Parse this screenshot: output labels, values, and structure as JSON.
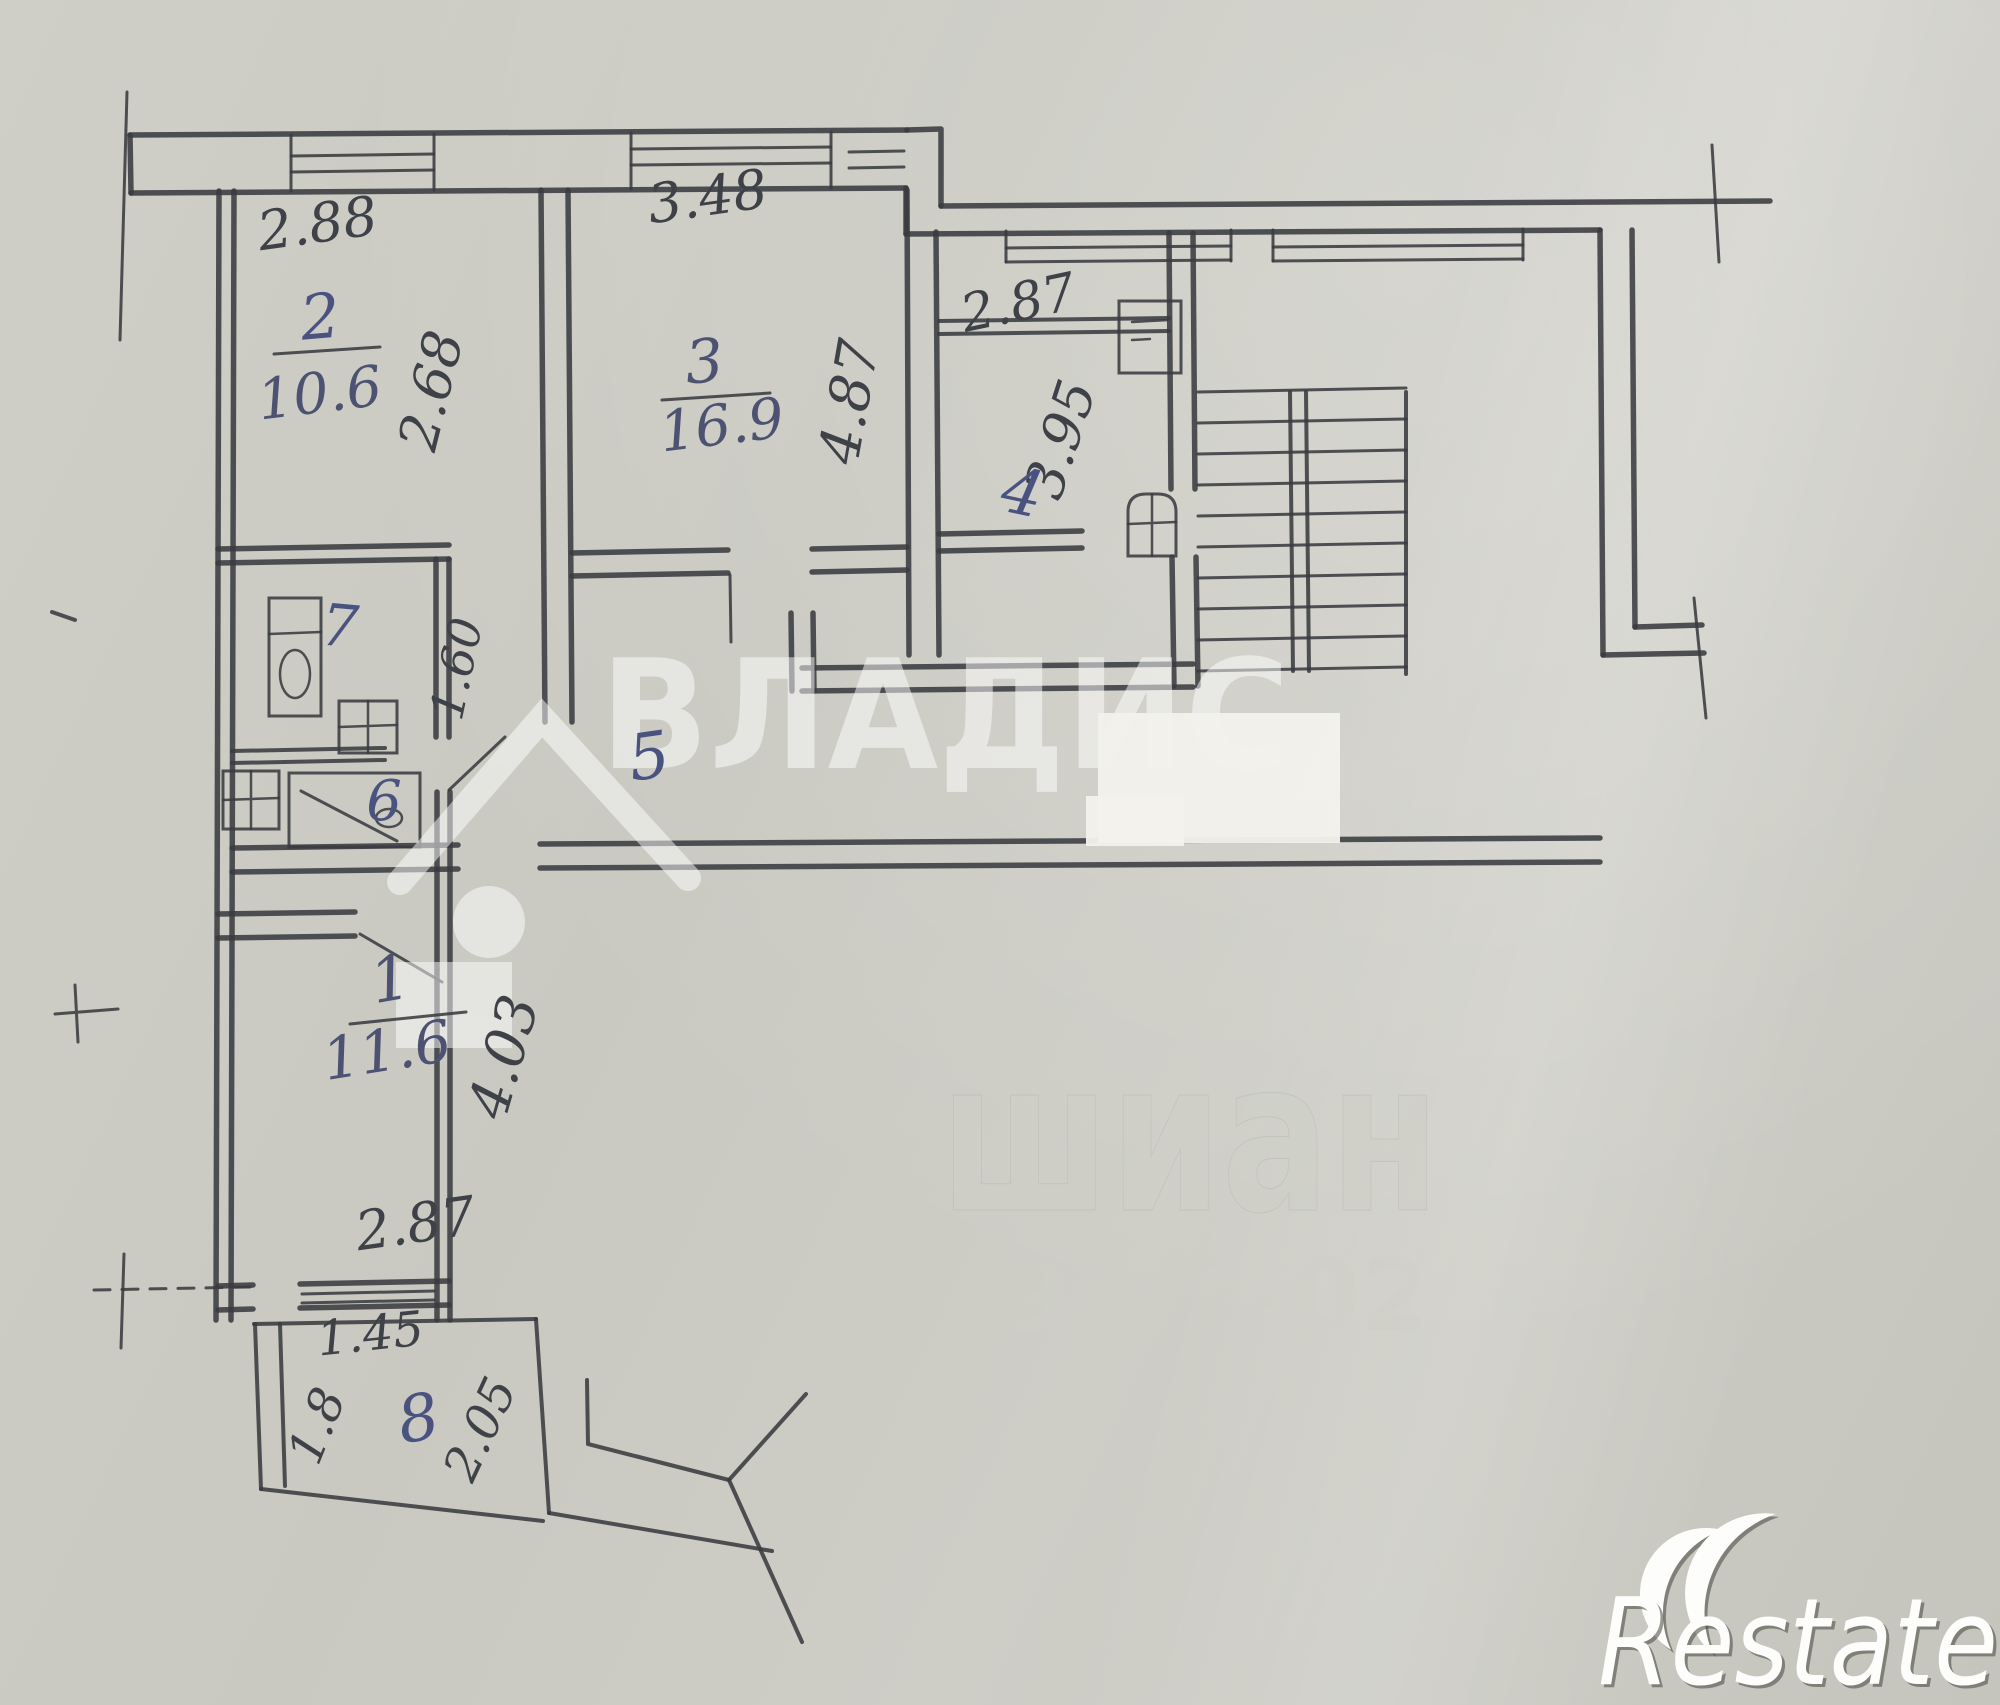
{
  "floor_plan": {
    "rooms": [
      {
        "number": "1",
        "area": "11.6"
      },
      {
        "number": "2",
        "area": "10.6"
      },
      {
        "number": "3",
        "area": "16.9"
      },
      {
        "number": "4"
      },
      {
        "number": "5"
      },
      {
        "number": "6"
      },
      {
        "number": "7"
      },
      {
        "number": "8"
      }
    ],
    "dimensions": {
      "room2_width": "2.88",
      "room2_depth": "2.68",
      "room3_width": "3.48",
      "room3_depth": "4.87",
      "room4_width": "2.87",
      "room4_depth": "3.95",
      "bath_passage_width": "1.60",
      "room1_depth": "4.03",
      "room1_width": "2.87",
      "balcony_width": "1.45",
      "balcony_side_left": "1.8",
      "balcony_side_right": "2.05"
    }
  },
  "watermarks": {
    "agency_logo_text": "ВЛАДИС",
    "restate_logo_text": "Restate",
    "faint_watermark_text": "шиан",
    "faint_watermark_digits": "9-92-02"
  },
  "style": {
    "paper_color": "#c9c9c1",
    "pencil_color": "#3a3b40",
    "ink_color": "#4a5380",
    "watermark_color": "#ffffff"
  }
}
